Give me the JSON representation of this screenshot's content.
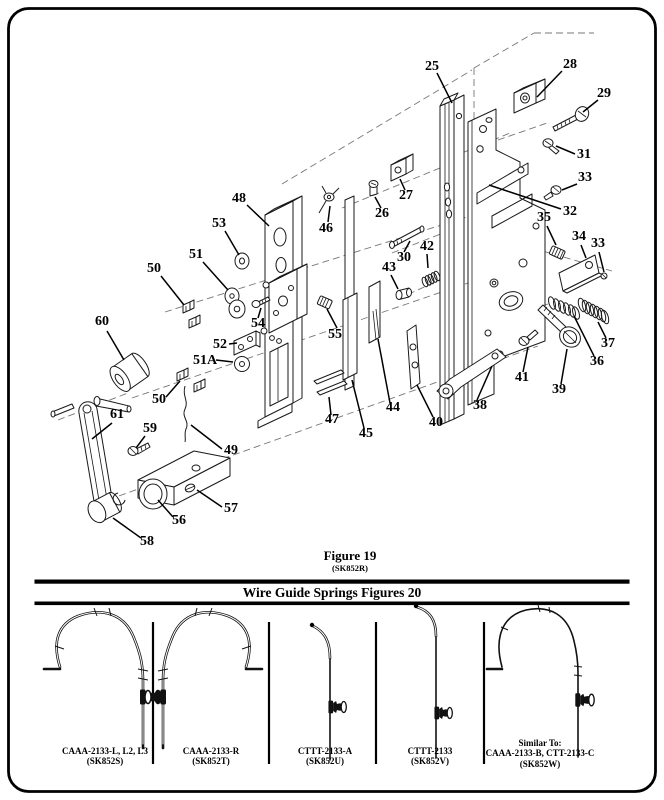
{
  "figure19": {
    "caption": "Figure 19",
    "subcaption": "(SK852R)",
    "part_numbers": {
      "p25": "25",
      "p26": "26",
      "p27": "27",
      "p28": "28",
      "p29": "29",
      "p30": "30",
      "p31": "31",
      "p32": "32",
      "p33": "33",
      "p33b": "33",
      "p34": "34",
      "p35": "35",
      "p36": "36",
      "p37": "37",
      "p38": "38",
      "p39": "39",
      "p40": "40",
      "p41": "41",
      "p42": "42",
      "p43": "43",
      "p44": "44",
      "p45": "45",
      "p46": "46",
      "p47": "47",
      "p48": "48",
      "p49": "49",
      "p50": "50",
      "p50b": "50",
      "p51": "51",
      "p51a": "51A",
      "p52": "52",
      "p53": "53",
      "p54": "54",
      "p55": "55",
      "p56": "56",
      "p57": "57",
      "p58": "58",
      "p59": "59",
      "p60": "60",
      "p61": "61"
    }
  },
  "figure20": {
    "header": "Wire Guide Springs  Figures 20",
    "panels": [
      {
        "lines": [
          "CAAA-2133-L, L2, L3",
          "(SK852S)"
        ]
      },
      {
        "lines": [
          "CAAA-2133-R",
          "(SK852T)"
        ]
      },
      {
        "lines": [
          "CTTT-2133-A",
          "(SK852U)"
        ]
      },
      {
        "lines": [
          "CTTT-2133",
          "(SK852V)"
        ]
      },
      {
        "lines": [
          "Similar To:",
          "CAAA-2133-B,  CTT-2133-C",
          "(SK852W)"
        ]
      }
    ]
  }
}
